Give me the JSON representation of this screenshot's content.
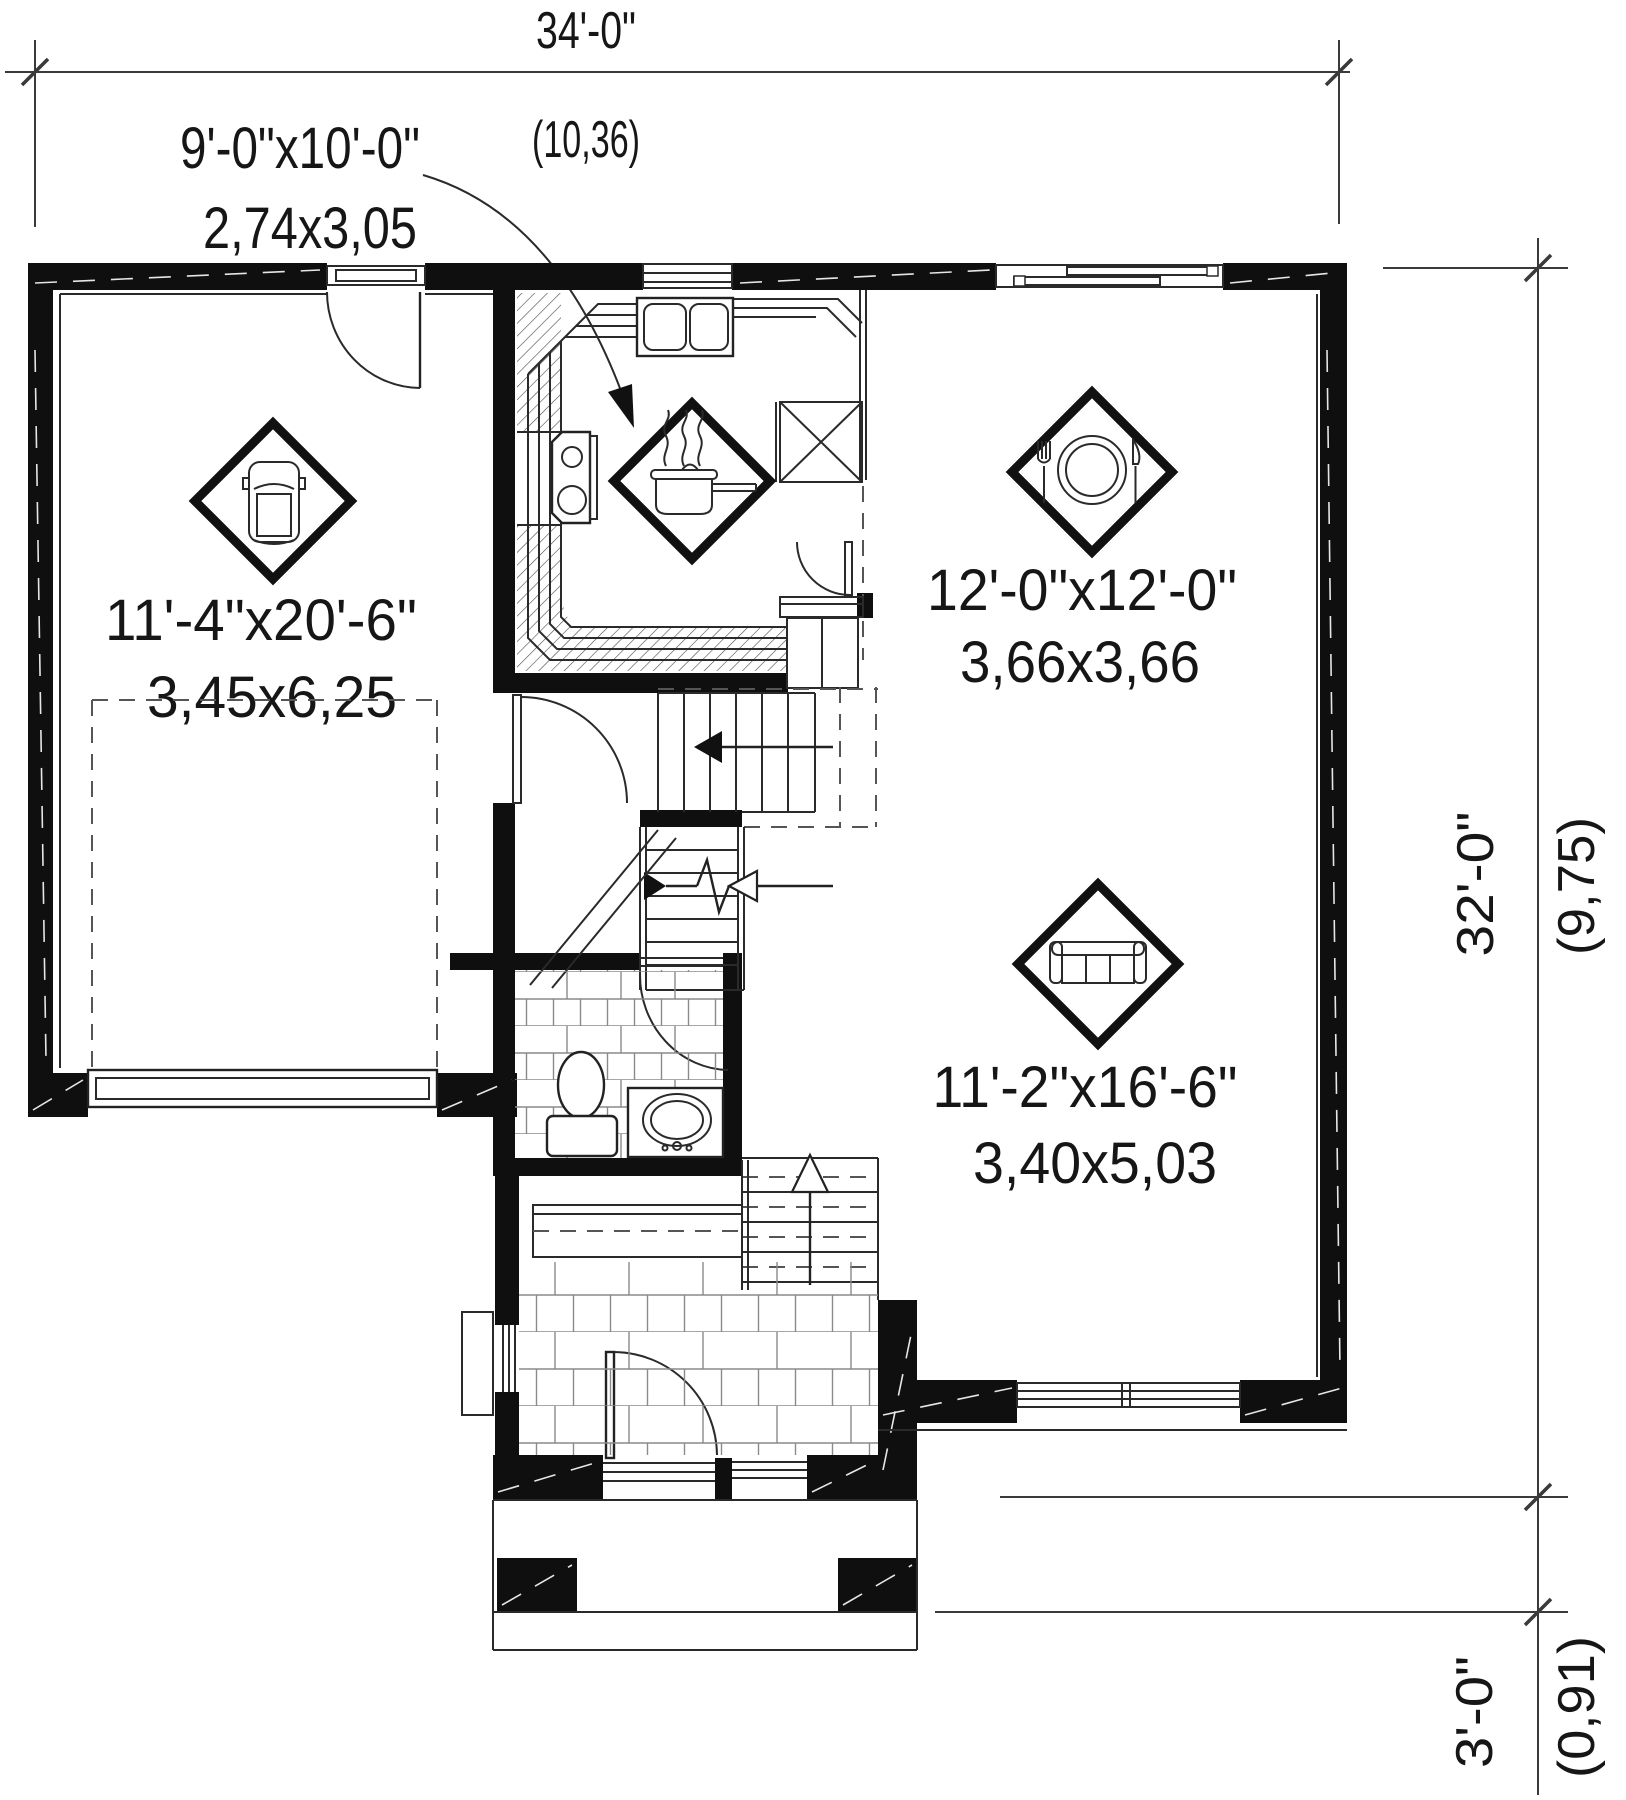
{
  "dimensions": {
    "overall_width": {
      "imperial": "34'-0\"",
      "metric": "(10,36)"
    },
    "overall_depth": {
      "imperial": "32'-0\"",
      "metric": "(9,75)"
    },
    "porch_depth": {
      "imperial": "3'-0\"",
      "metric": "(0,91)"
    }
  },
  "rooms": {
    "kitchen": {
      "imperial": "9'-0\"x10'-0\"",
      "metric": "2,74x3,05",
      "icon": "cooking-pot-icon"
    },
    "garage": {
      "imperial": "11'-4\"x20'-6\"",
      "metric": "3,45x6,25",
      "icon": "car-icon"
    },
    "dining_room": {
      "imperial": "12'-0\"x12'-0\"",
      "metric": "3,66x3,66",
      "icon": "place-setting-icon"
    },
    "living_room": {
      "imperial": "11'-2\"x16'-6\"",
      "metric": "3,40x5,03",
      "icon": "sofa-icon"
    }
  },
  "colors": {
    "wall": "#0f0f0f",
    "line": "#2a2a2a",
    "background": "#ffffff"
  }
}
